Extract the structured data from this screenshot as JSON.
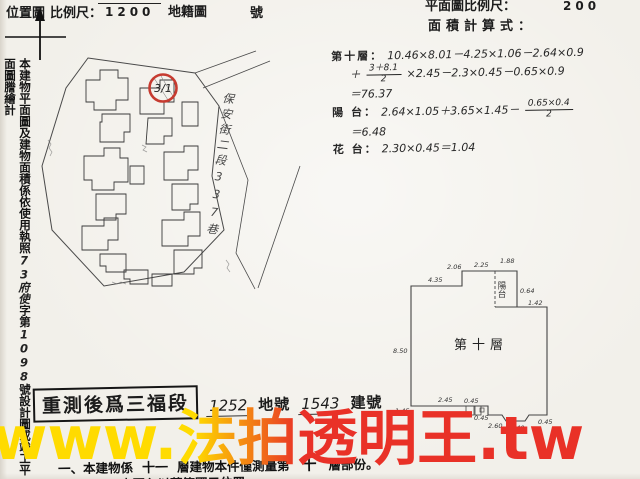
{
  "header": {
    "left": {
      "location_map": "位置圖",
      "scale_label": "比例尺：",
      "scale_value": "1200",
      "cadastral_label": "地籍圖",
      "sheet_label": "號"
    },
    "right": {
      "plan_scale_label": "平面圖比例尺：",
      "plan_scale_value": "200",
      "area_formula_label": "面積計算式："
    }
  },
  "side_note": {
    "printed_1": "本建物平面圖及建物面積係依使用執照",
    "handwritten_1": "73府使",
    "printed_2": "字第",
    "handwritten_2": "1098",
    "printed_3": "號設計圖或竣工平面圖謄繪計"
  },
  "map": {
    "marker": "3/1",
    "street": "保安街二段337巷"
  },
  "calc": {
    "floor_label": "第十層：",
    "floor_line1": "10.46×8.01－4.25×1.06－2.64×0.9",
    "plus": "＋",
    "frac1_num": "3＋8.1",
    "frac1_den": "2",
    "floor_line2_rest": "×2.45－2.3×0.45－0.65×0.9",
    "floor_total": "＝76.37",
    "balcony_label": "陽 台：",
    "balcony_line": "2.64×1.05＋3.65×1.45－",
    "frac2_num": "0.65×0.4",
    "frac2_den": "2",
    "balcony_total": "＝6.48",
    "flower_label": "花 台：",
    "flower_line": "2.30×0.45＝1.04"
  },
  "plan": {
    "title": "第十層",
    "balcony": "陽台",
    "dims": {
      "left": "8.50",
      "t1": "4.35",
      "t2": "2.06",
      "t3": "2.25",
      "t4": "1.88",
      "r1": "0.64",
      "r2": "1.42",
      "b1": "2.45",
      "b2": "0.45",
      "b3": "0.45",
      "b4": "2.60",
      "b5": "1.45",
      "b6": "2.40",
      "b7": "0.45"
    }
  },
  "stamp": {
    "boxed": "重測後爲三福段",
    "lot_number": "1252",
    "lot_label": "地號",
    "building_number": "1543",
    "building_label": "建號"
  },
  "notes": {
    "line1_prefix": "一、本建物係",
    "line1_floors": "十一",
    "line1_mid": "層建物本件僅測量第",
    "line1_floor": "十",
    "line1_suffix": "層部份。",
    "line2": "二、本圖內以藍筆圈示位置"
  },
  "watermark": {
    "text": "www.法拍透明王.tw",
    "yellow": "#ffdb00",
    "red": "#e93127"
  }
}
